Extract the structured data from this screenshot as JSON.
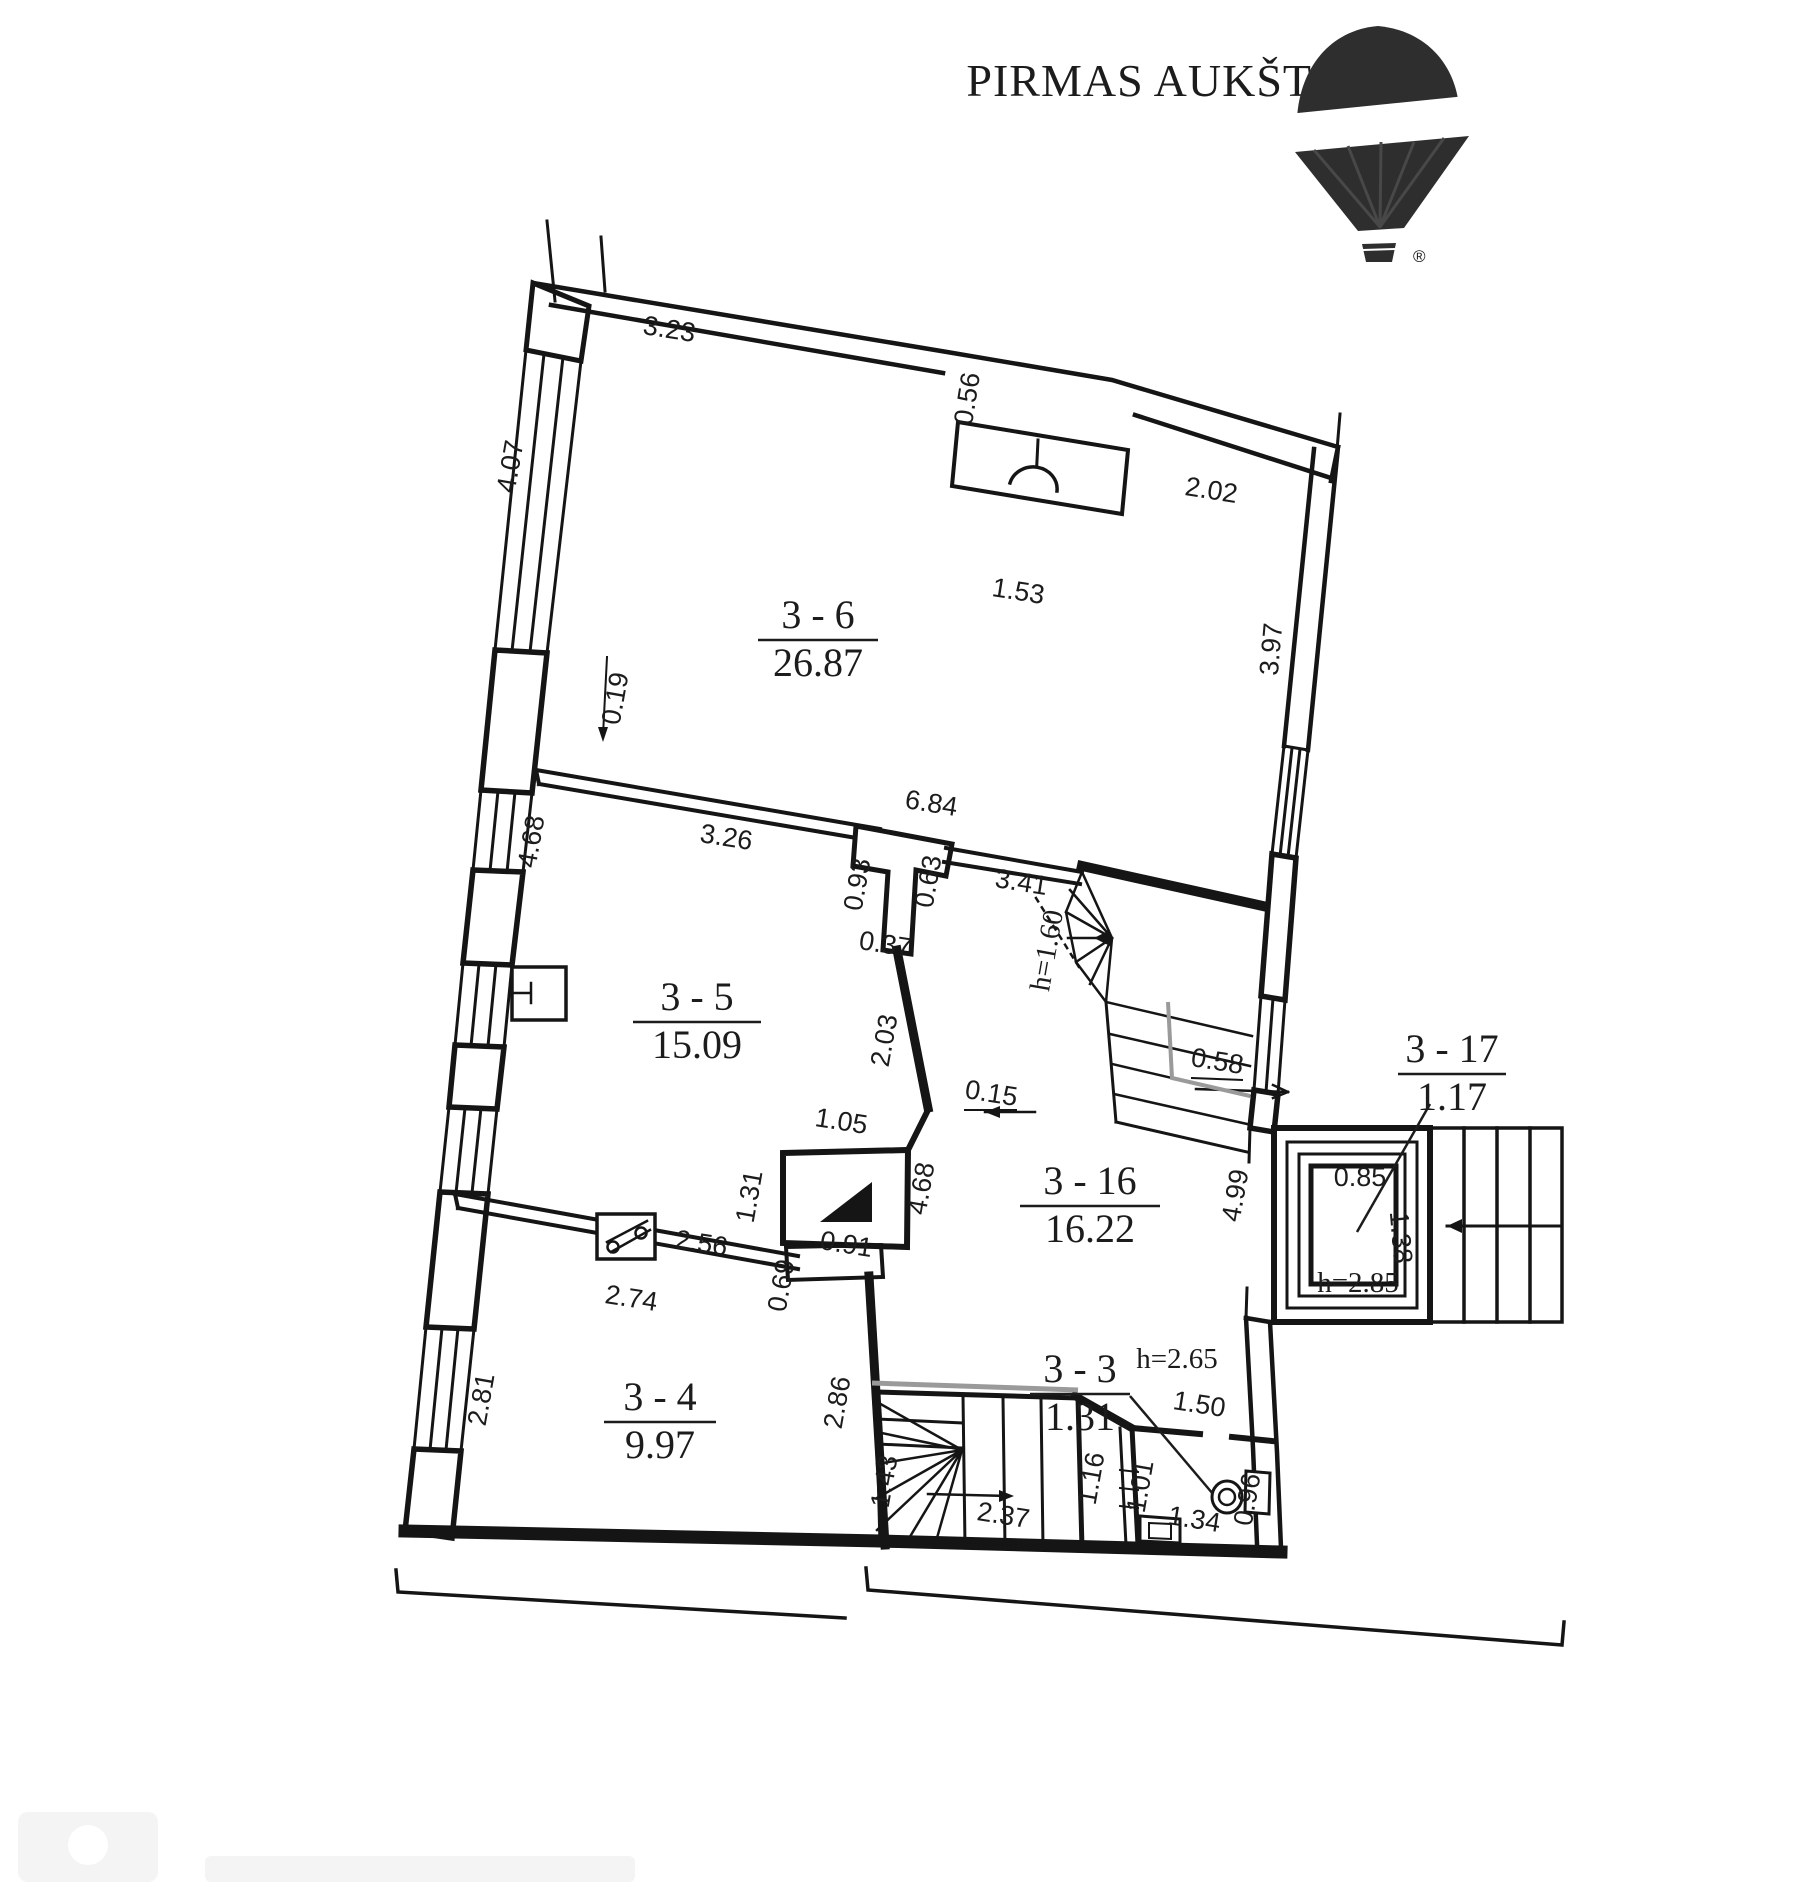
{
  "title": "PIRMAS AUKŠT",
  "logo": {
    "brand": "RE/MAX",
    "registered_mark": "®",
    "icon": "hot-air-balloon-icon",
    "color": "#2e2e2e"
  },
  "colors": {
    "ink": "#1c1c1c",
    "wall": "#151515",
    "gray_edge": "#9a9a9a",
    "background": "#ffffff"
  },
  "watermark": {
    "icon": "faint-watermark",
    "legible": false
  },
  "rooms": [
    {
      "id": "3 - 6",
      "area": "26.87",
      "x": 818,
      "y": 628,
      "uw": 60,
      "leader": null
    },
    {
      "id": "3 - 5",
      "area": "15.09",
      "x": 697,
      "y": 1010,
      "uw": 64,
      "leader": null
    },
    {
      "id": "3 - 16",
      "area": "16.22",
      "x": 1090,
      "y": 1194,
      "uw": 70,
      "leader": null
    },
    {
      "id": "3 - 4",
      "area": "9.97",
      "x": 660,
      "y": 1410,
      "uw": 56,
      "leader": null
    },
    {
      "id": "3 - 3",
      "area": "1.31",
      "x": 1080,
      "y": 1382,
      "uw": 50,
      "leader": [
        1130,
        1396,
        1213,
        1494
      ]
    },
    {
      "id": "3 - 17",
      "area": "1.17",
      "x": 1452,
      "y": 1062,
      "uw": 54,
      "leader": [
        1430,
        1104,
        1357,
        1232
      ]
    }
  ],
  "dims": [
    {
      "t": "3.23",
      "x": 668,
      "y": 338,
      "r": 9
    },
    {
      "t": "0.56",
      "x": 976,
      "y": 400,
      "r": -81
    },
    {
      "t": "1.53",
      "x": 1017,
      "y": 600,
      "r": 9
    },
    {
      "t": "2.02",
      "x": 1210,
      "y": 499,
      "r": 9
    },
    {
      "t": "4.07",
      "x": 519,
      "y": 468,
      "r": -80
    },
    {
      "t": "3.97",
      "x": 1280,
      "y": 650,
      "r": -85
    },
    {
      "t": "0.19",
      "x": 624,
      "y": 700,
      "r": -80
    },
    {
      "t": "3.26",
      "x": 725,
      "y": 846,
      "r": 9
    },
    {
      "t": "6.84",
      "x": 930,
      "y": 812,
      "r": 9
    },
    {
      "t": "0.93",
      "x": 866,
      "y": 886,
      "r": -80
    },
    {
      "t": "0.63",
      "x": 937,
      "y": 883,
      "r": -80
    },
    {
      "t": "3.41",
      "x": 1020,
      "y": 891,
      "r": 9
    },
    {
      "t": "h=1.60",
      "x": 1056,
      "y": 952,
      "r": -80,
      "serif": true
    },
    {
      "t": "0.37",
      "x": 884,
      "y": 953,
      "r": 9
    },
    {
      "t": "2.03",
      "x": 893,
      "y": 1042,
      "r": -80
    },
    {
      "t": "4.68",
      "x": 540,
      "y": 843,
      "r": -80
    },
    {
      "t": "0.15",
      "x": 990,
      "y": 1102,
      "r": 9,
      "u": true
    },
    {
      "t": "0.58",
      "x": 1216,
      "y": 1070,
      "r": 9,
      "u": true
    },
    {
      "t": "1.05",
      "x": 840,
      "y": 1130,
      "r": 9
    },
    {
      "t": "4.68",
      "x": 930,
      "y": 1190,
      "r": -80
    },
    {
      "t": "4.99",
      "x": 1244,
      "y": 1197,
      "r": -80
    },
    {
      "t": "0.85",
      "x": 1360,
      "y": 1186,
      "r": 0
    },
    {
      "t": "1.38",
      "x": 1392,
      "y": 1238,
      "r": 85
    },
    {
      "t": "h=2.85",
      "x": 1358,
      "y": 1292,
      "r": 0,
      "serif": true
    },
    {
      "t": "1.31",
      "x": 758,
      "y": 1198,
      "r": -80
    },
    {
      "t": "2.56",
      "x": 700,
      "y": 1252,
      "r": 9
    },
    {
      "t": "0.91",
      "x": 845,
      "y": 1253,
      "r": 9
    },
    {
      "t": "0.69",
      "x": 790,
      "y": 1287,
      "r": -80
    },
    {
      "t": "2.74",
      "x": 630,
      "y": 1307,
      "r": 9
    },
    {
      "t": "2.81",
      "x": 490,
      "y": 1401,
      "r": -80
    },
    {
      "t": "2.86",
      "x": 846,
      "y": 1404,
      "r": -80
    },
    {
      "t": "h=2.65",
      "x": 1177,
      "y": 1368,
      "r": 0,
      "serif": true
    },
    {
      "t": "1.50",
      "x": 1198,
      "y": 1413,
      "r": 9
    },
    {
      "t": "1.43",
      "x": 893,
      "y": 1483,
      "r": -80
    },
    {
      "t": "2.37",
      "x": 1002,
      "y": 1524,
      "r": 9
    },
    {
      "t": "1.16",
      "x": 1100,
      "y": 1480,
      "r": -80
    },
    {
      "t": "1.01",
      "x": 1149,
      "y": 1488,
      "r": -80
    },
    {
      "t": "1.34",
      "x": 1193,
      "y": 1528,
      "r": 9
    },
    {
      "t": "0.96",
      "x": 1256,
      "y": 1501,
      "r": -80
    }
  ]
}
